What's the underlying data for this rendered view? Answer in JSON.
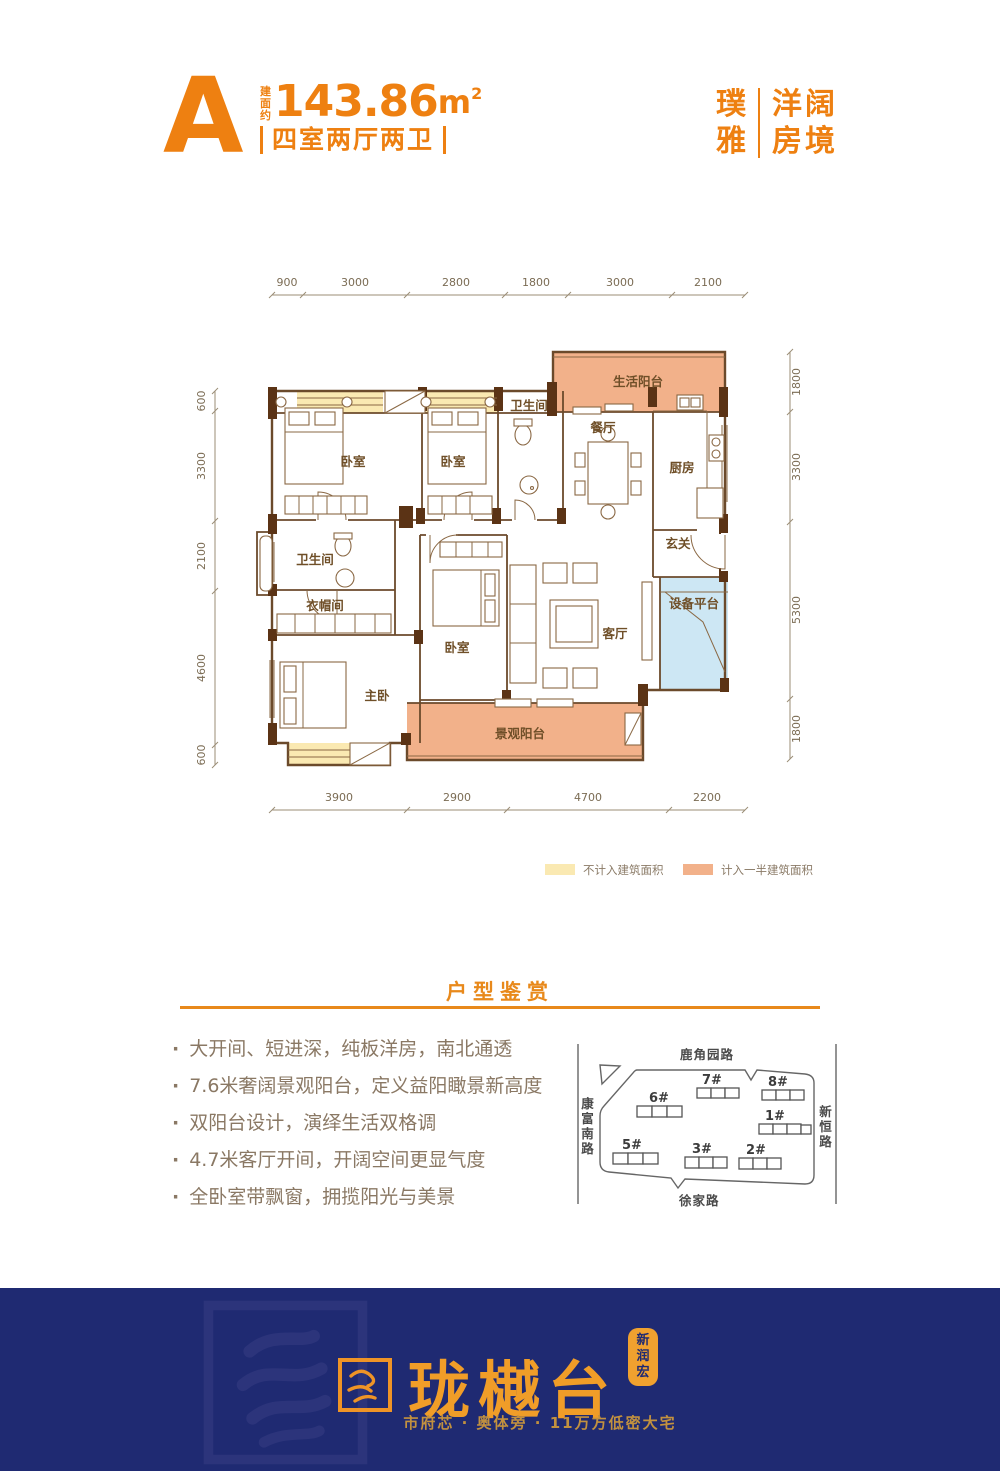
{
  "header": {
    "type_letter": "A",
    "area_prefix": "建面约",
    "area_value": "143.86",
    "area_unit": "m",
    "area_sup": "2",
    "layout_text": "四室两厅两卫",
    "brand_col1_line1": "璞",
    "brand_col1_line2": "雅",
    "brand_col2_line1": "洋阔",
    "brand_col2_line2": "房境"
  },
  "floorplan": {
    "dims_top": [
      "900",
      "3000",
      "2800",
      "1800",
      "3000",
      "2100"
    ],
    "dims_bottom": [
      "3900",
      "2900",
      "4700",
      "2200"
    ],
    "dims_left": [
      "600",
      "3300",
      "2100",
      "4600",
      "600"
    ],
    "dims_right": [
      "1800",
      "3300",
      "5300",
      "1800"
    ],
    "rooms": {
      "bedroom1": "卧室",
      "bedroom2": "卧室",
      "bath1": "卫生间",
      "dining": "餐厅",
      "kitchen": "厨房",
      "foyer": "玄关",
      "life_balcony": "生活阳台",
      "bath2": "卫生间",
      "cloakroom": "衣帽间",
      "bedroom3": "卧室",
      "master": "主卧",
      "living": "客厅",
      "equipment": "设备平台",
      "view_balcony": "景观阳台"
    },
    "legend": [
      {
        "label": "不计入建筑面积",
        "color": "#fae9b2"
      },
      {
        "label": "计入一半建筑面积",
        "color": "#f2b18a"
      }
    ],
    "equipment_color": "#cde7f4"
  },
  "section": {
    "title": "户型鉴赏",
    "bullets": [
      "大开间、短进深，纯板洋房，南北通透",
      "7.6米奢阔景观阳台，定义益阳瞰景新高度",
      "双阳台设计，演绎生活双格调",
      "4.7米客厅开间，开阔空间更显气度",
      "全卧室带飘窗，拥揽阳光与美景"
    ]
  },
  "sitemap": {
    "road_top": "鹿角园路",
    "road_left": "康富南路",
    "road_right": "新恒路",
    "road_bottom": "徐家路",
    "buildings": [
      {
        "id": "7#"
      },
      {
        "id": "8#"
      },
      {
        "id": "6#"
      },
      {
        "id": "1#"
      },
      {
        "id": "5#"
      },
      {
        "id": "3#"
      },
      {
        "id": "2#"
      }
    ],
    "highlight_color": "#ee7d1f"
  },
  "footer": {
    "logo_text": "珑樾台",
    "seal_text": "新润宏",
    "tagline": "市府芯 · 奥体旁 · 11万方低密大宅"
  },
  "colors": {
    "accent_orange": "#ee8011",
    "rule_orange": "#e8891b",
    "wall_brown": "#6b4a2b",
    "pier_brown": "#5b3315",
    "footer_bg": "#1f2a72",
    "footer_gold": "#f09d28",
    "footer_tagline": "#c2913f"
  }
}
